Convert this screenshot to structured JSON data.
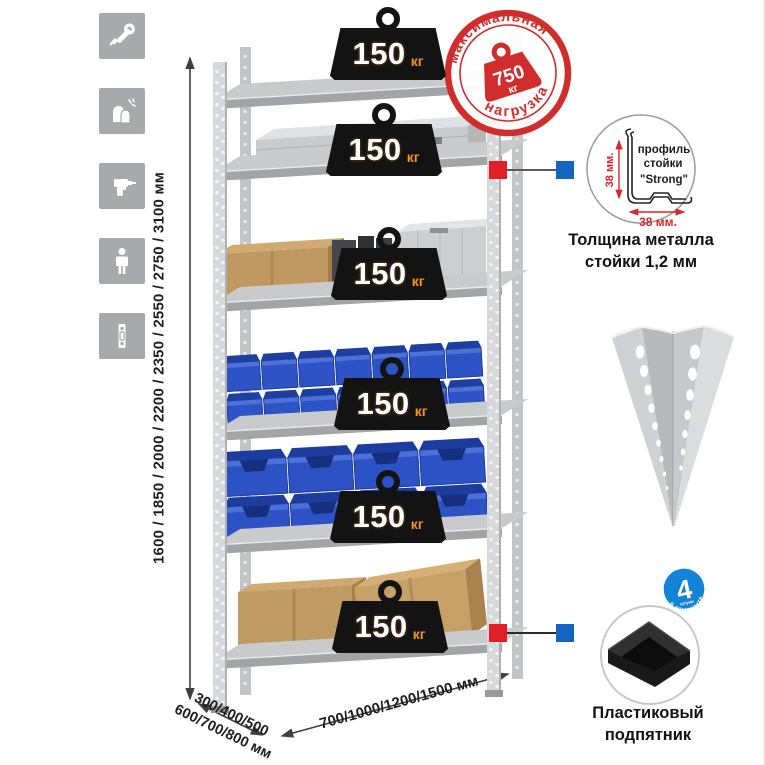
{
  "icons": {
    "list": [
      "wrench-icon",
      "gloves-icon",
      "drill-icon",
      "person-icon",
      "post-profile-icon"
    ]
  },
  "dimensions": {
    "height": "1600 / 1850 / 2000 / 2200 / 2350 / 2550 / 2750 / 3100 мм",
    "depth_line1": "300/400/500",
    "depth_line2": "600/700/800 мм",
    "width": "700/1000/1200/1500 мм"
  },
  "rack": {
    "shelf_count": 6,
    "shelves": [
      {
        "load": "150",
        "unit": "кг"
      },
      {
        "load": "150",
        "unit": "кг"
      },
      {
        "load": "150",
        "unit": "кг"
      },
      {
        "load": "150",
        "unit": "кг"
      },
      {
        "load": "150",
        "unit": "кг"
      },
      {
        "load": "150",
        "unit": "кг"
      }
    ]
  },
  "max_load_stamp": {
    "arc_top": "максимальная",
    "arc_bottom": "нагрузка",
    "value": "750",
    "unit": "кг"
  },
  "profile_detail": {
    "label_line1": "профиль",
    "label_line2": "стойки",
    "label_line3": "\"Strong\"",
    "dim_vertical": "38 мм.",
    "dim_horizontal": "38 мм.",
    "caption_line1": "Толщина металла",
    "caption_line2": "стойки 1,2 мм"
  },
  "foot_detail": {
    "badge_value": "4",
    "badge_sub": "штуки",
    "badge_arc": "в комплекте",
    "caption_line1": "Пластиковый",
    "caption_line2": "подпятник"
  },
  "colors": {
    "stamp_red": "#cf2e2d",
    "unit_orange": "#f7941d",
    "bin_blue": "#2d53c6",
    "marker_red": "#e01f26",
    "marker_blue": "#1565c0",
    "badge_blue": "#1283d6",
    "icon_gray": "#a7a9ab",
    "metal_gray": "#c8cacc"
  }
}
